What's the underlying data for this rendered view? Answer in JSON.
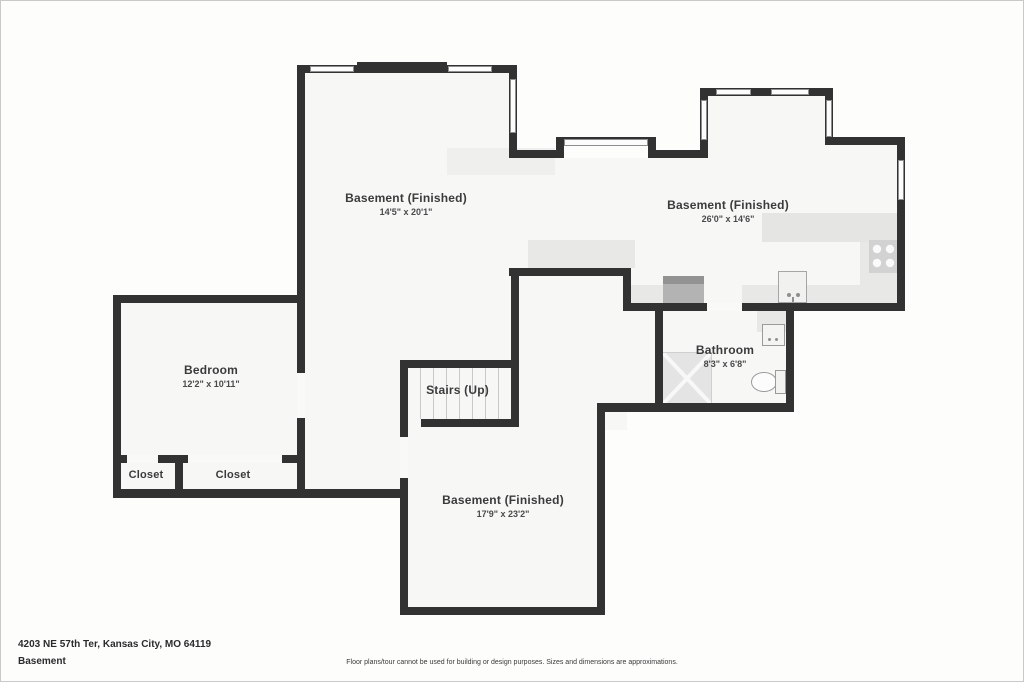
{
  "plan": {
    "rooms": [
      {
        "id": "basement-nw",
        "name": "Basement (Finished)",
        "dims": "14'5\" x 20'1\""
      },
      {
        "id": "basement-ne",
        "name": "Basement (Finished)",
        "dims": "26'0\" x 14'6\""
      },
      {
        "id": "bedroom",
        "name": "Bedroom",
        "dims": "12'2\" x 10'11\""
      },
      {
        "id": "stairs",
        "name": "Stairs (Up)",
        "dims": ""
      },
      {
        "id": "bathroom",
        "name": "Bathroom",
        "dims": "8'3\" x 6'8\""
      },
      {
        "id": "basement-s",
        "name": "Basement (Finished)",
        "dims": "17'9\" x 23'2\""
      },
      {
        "id": "closet-left",
        "name": "Closet",
        "dims": ""
      },
      {
        "id": "closet-right",
        "name": "Closet",
        "dims": ""
      }
    ],
    "footer": {
      "address": "4203 NE 57th Ter, Kansas City, MO 64119",
      "level": "Basement",
      "disclaimer": "Floor plans/tour cannot be used for building or design purposes. Sizes and dimensions are approximations."
    },
    "colors": {
      "wall": "#323232",
      "room_fill": "#f7f7f6",
      "fixture": "#e8e8e7"
    }
  }
}
